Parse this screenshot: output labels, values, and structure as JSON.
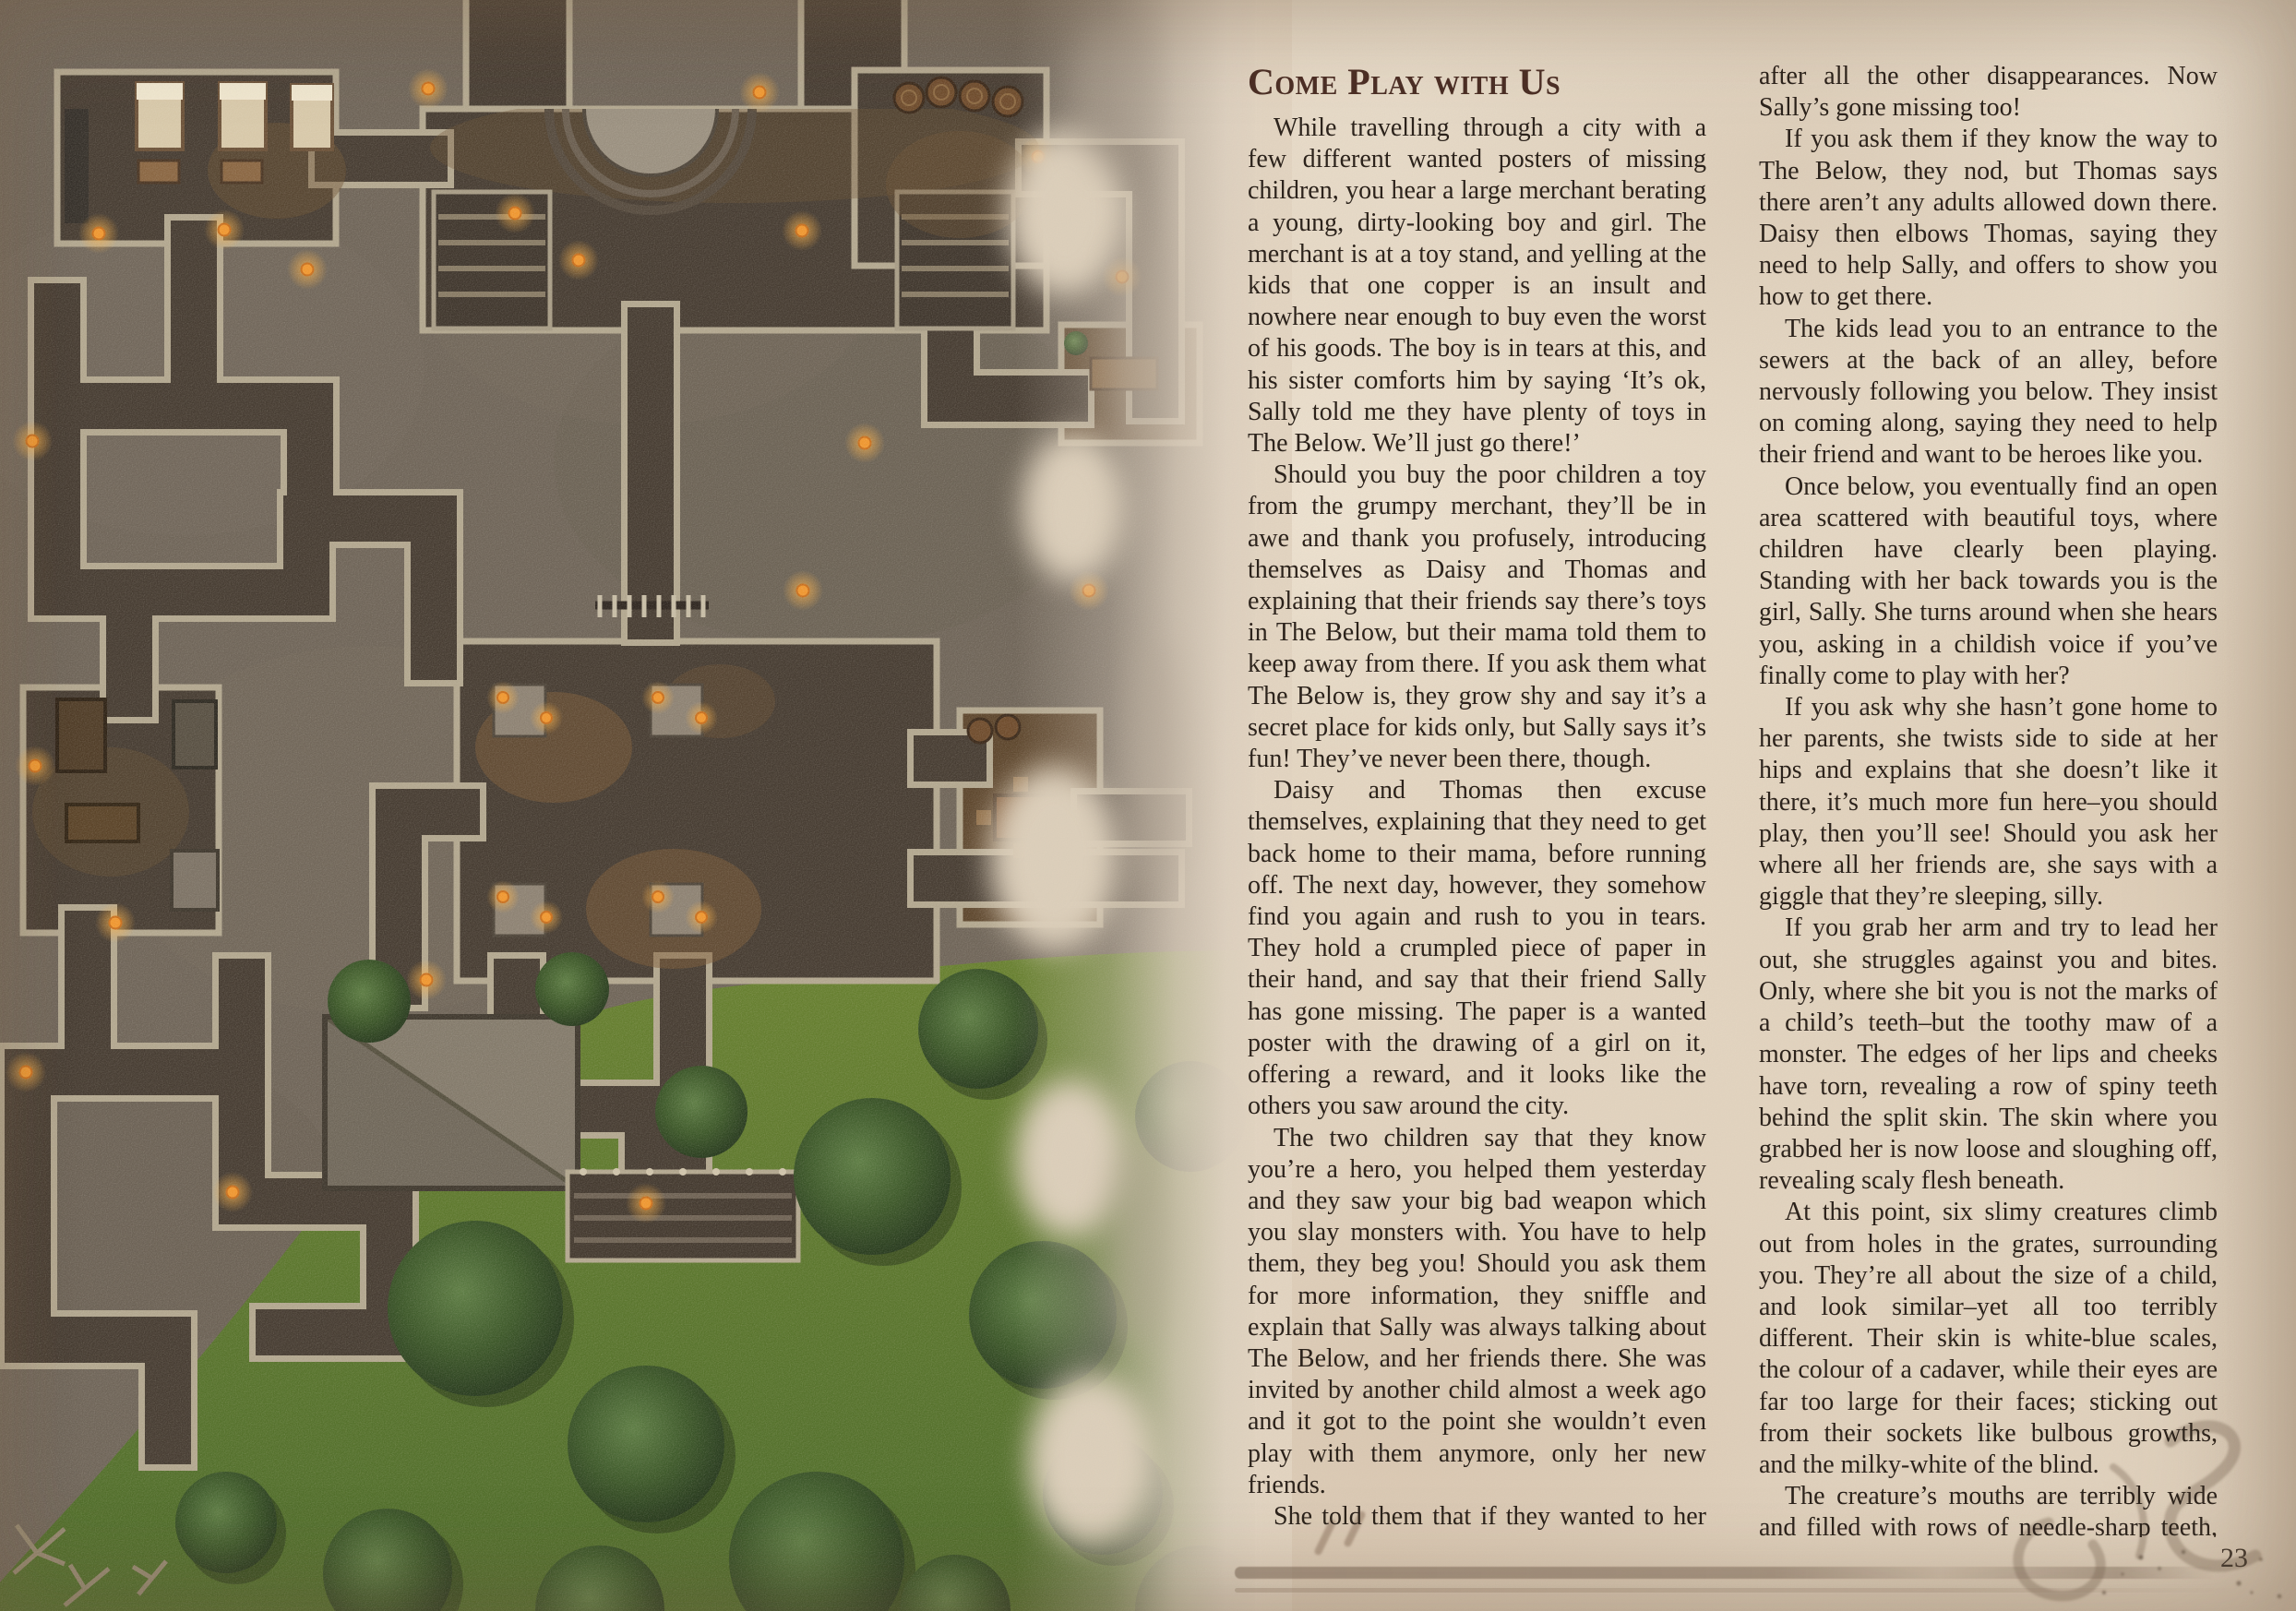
{
  "page": {
    "number": "23",
    "section_title": "Come Play with Us"
  },
  "content": {
    "left": [
      "While travelling through a city with a few different wanted posters of missing children, you hear a large merchant berating a young, dirty-looking boy and girl. The merchant is at a toy stand, and yelling at the kids that one copper is an insult and nowhere near enough to buy even the worst of his goods. The boy is in tears at this, and his sister comforts him by saying ‘It’s ok, Sally told me they have plenty of toys in The Below. We’ll just go there!’",
      "Should you buy the poor children a toy from the grumpy merchant, they’ll be in awe and thank you profusely, introducing themselves as Daisy and Thomas and explaining that their friends say there’s toys in The Below, but their mama told them to keep away from there. If you ask them what The Below is, they grow shy and say it’s a secret place for kids only, but Sally says it’s fun! They’ve never been there, though.",
      "Daisy and Thomas then excuse themselves, explaining that they need to get back home to their mama, before running off. The next day, however, they somehow find you again and rush to you in tears. They hold a crumpled piece of paper in their hand, and say that their friend Sally has gone missing. The paper is a wanted poster with the drawing of a girl on it, offering a reward, and it looks like the others you saw around the city.",
      "The two children say that they know you’re a hero, you helped them yesterday and they saw your big bad weapon which you slay monsters with. You have to help them, they beg you! Should you ask them for more information, they sniffle and explain that Sally was always talking about The Below, and her friends there. She was invited by another child almost a week ago and it got to the point she wouldn’t even play with them anymore, only her new friends.",
      "She told them that if they wanted to her company they should go with her to The Below, and then they would see how good it is! But Thomas and Daisy asked their mama for permission and she told them it wasn’t safe,"
    ],
    "right": [
      "after all the other disappearances. Now Sally’s gone missing too!",
      "If you ask them if they know the way to The Below, they nod, but Thomas says there aren’t any adults allowed down there. Daisy then elbows Thomas, saying they need to help Sally, and offers to show you how to get there.",
      "The kids lead you to an entrance to the sewers at the back of an alley, before nervously following you below. They insist on coming along, saying they need to help their friend and want to be heroes like you.",
      "Once below, you eventually find an open area scattered with beautiful toys, where children have clearly been playing. Standing with her back towards you is the girl, Sally. She turns around when she hears you, asking in a childish voice if you’ve finally come to play with her?",
      "If you ask why she hasn’t gone home to her parents, she twists side to side at her hips and explains that she doesn’t like it there, it’s much more fun here–you should play, then you’ll see! Should you ask her where all her friends are, she says with a giggle that they’re sleeping, silly.",
      "If you grab her arm and try to lead her out, she struggles against you and bites. Only, where she bit you is not the marks of a child’s teeth–but the toothy maw of a monster. The edges of her lips and cheeks have torn, revealing a row of spiny teeth behind the split skin. The skin where you grabbed her is now loose and sloughing off, revealing scaly flesh beneath.",
      "At this point, six slimy creatures climb out from holes in the grates, surrounding you. They’re all about the size of a child, and look similar–yet all too terribly different. Their skin is white-blue scales, the colour of a cadaver, while their eyes are far too large for their faces; sticking out from their sockets like bulbous growths, and the milky-white of the blind.",
      "The creature’s mouths are terribly wide and filled with rows of needle-sharp teeth, while they have long, slimy tongues. Their fingers and toes are webbed and clawed, and the tiny stump of a tail curves down ever so slightly between their"
    ]
  },
  "page_palette": {
    "parchment": "#e4d7c4",
    "parchment_deep": "#d9c8b2",
    "title_color": "#4b2e25",
    "text_color": "#2b221b",
    "rule_color": "#766353",
    "flourish_color": "#9b8773"
  },
  "map_palette": {
    "stone": "#6f6559",
    "floor": "#463c32",
    "wall": "#b2a78f",
    "warm_floor": "#5c452c",
    "torch": "#f0972f",
    "grass": "#5e7a30",
    "tree": "#2d4421",
    "roof": "#837a6b",
    "wood": "#7a5833",
    "mattress": "#d8c9aa"
  }
}
